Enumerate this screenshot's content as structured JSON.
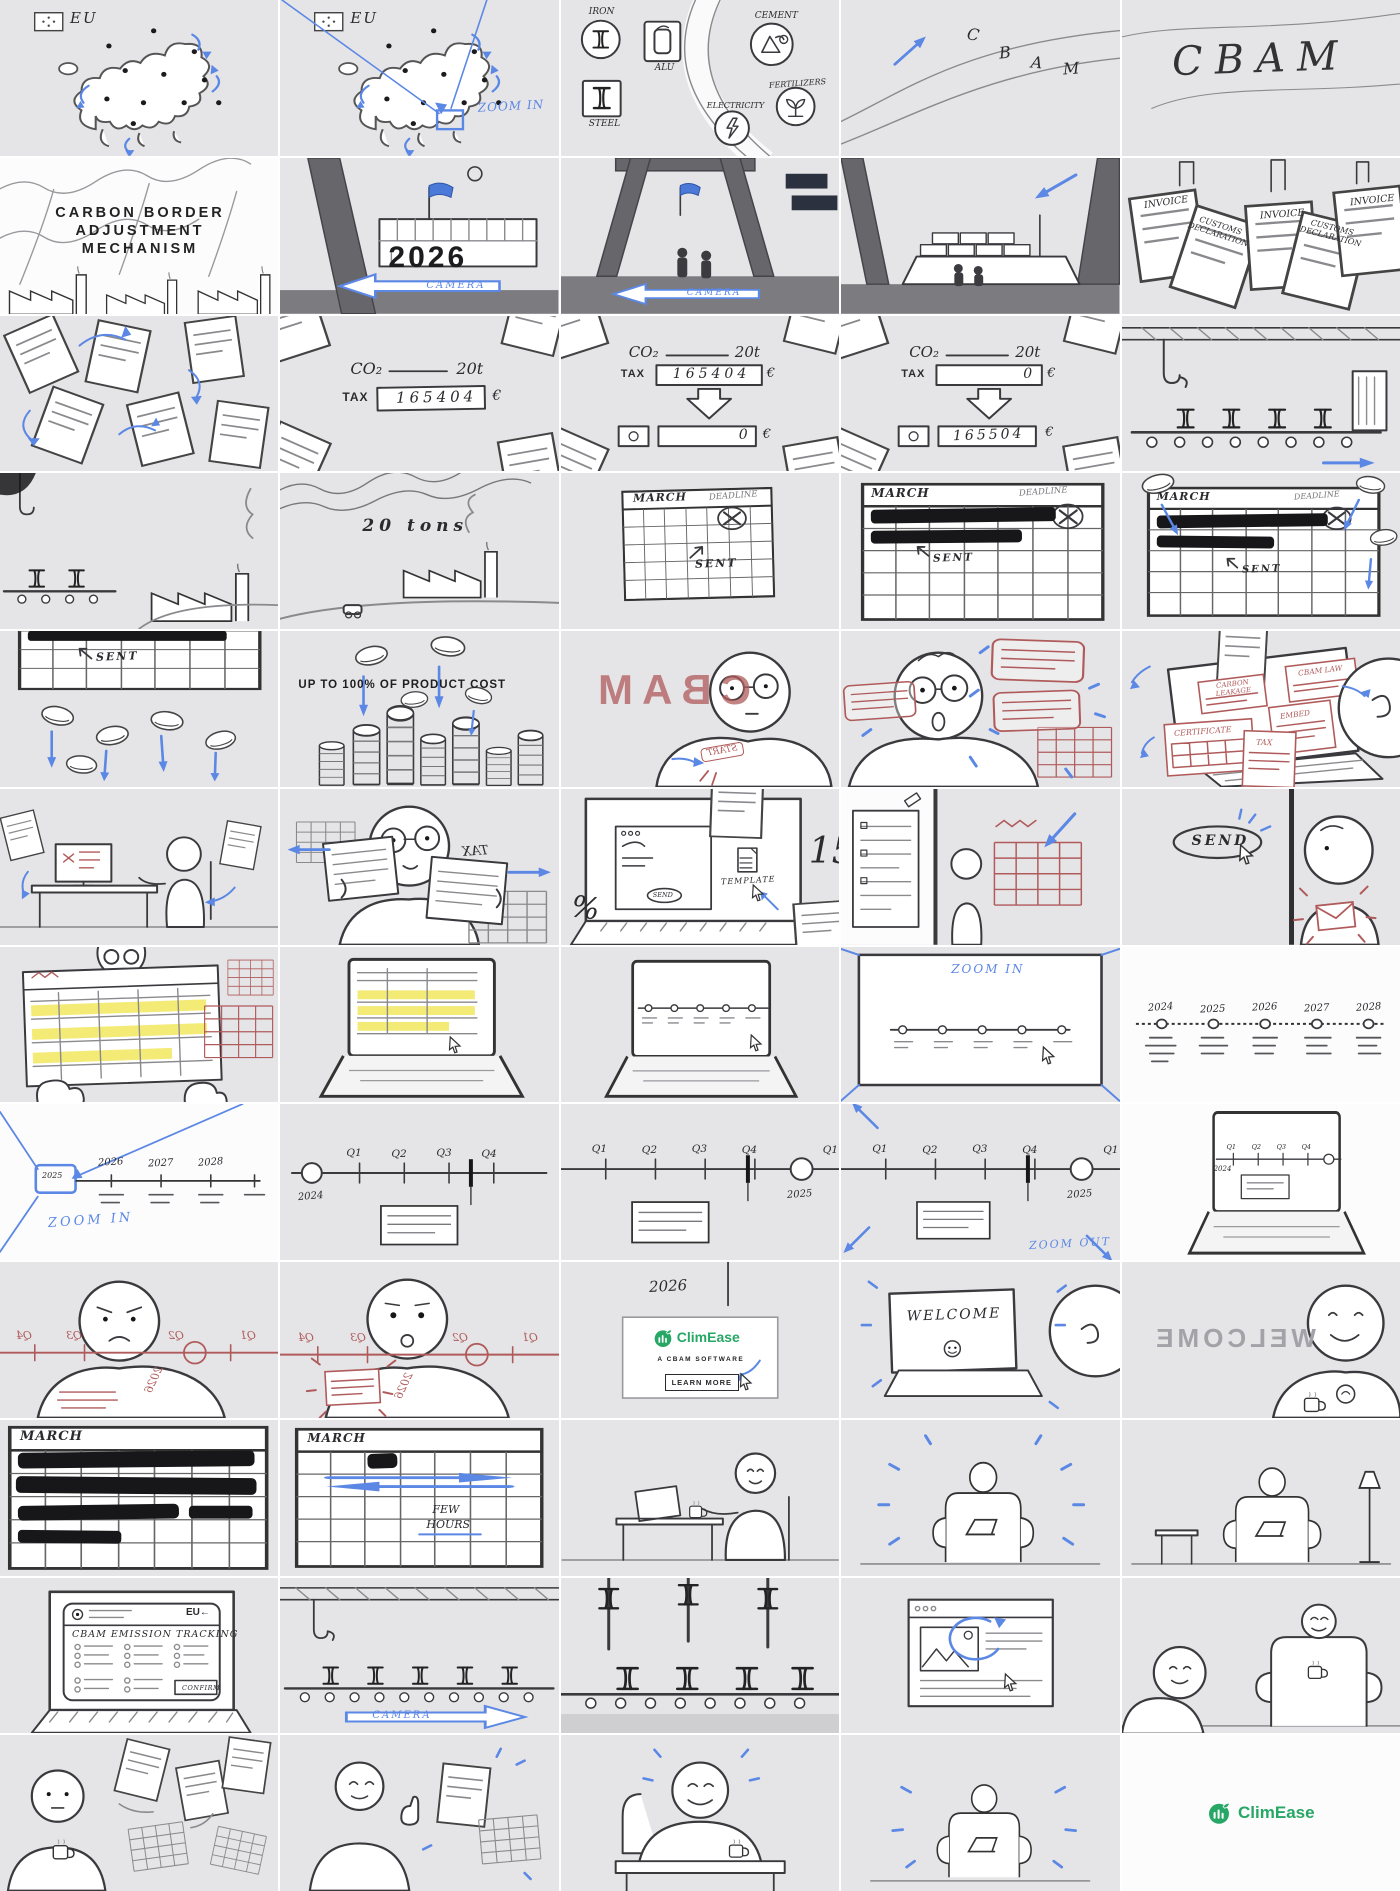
{
  "colors": {
    "panel_bg": "#e5e5e7",
    "blue": "#5b87e5",
    "red": "#b05b5b",
    "green": "#27a765",
    "yellow": "#f1e75e",
    "ink": "#2b2b2f"
  },
  "panels": {
    "r1c1": {
      "eu": "EU"
    },
    "r1c2": {
      "eu": "EU",
      "zoom": "ZOOM IN"
    },
    "r1c3": {
      "iron": "IRON",
      "alu": "ALU",
      "steel": "STEEL",
      "cement": "CEMENT",
      "electricity": "ELECTRICITY",
      "fertilizers": "FERTILIZERS"
    },
    "r1c4": {
      "l1": "C",
      "l2": "B",
      "l3": "A",
      "l4": "M"
    },
    "r1c5": {
      "title": "CBAM"
    },
    "r2c1": {
      "line1": "CARBON BORDER",
      "line2": "ADJUSTMENT",
      "line3": "MECHANISM"
    },
    "r2c2": {
      "year": "2026",
      "camera": "CAMERA"
    },
    "r2c3": {
      "camera": "CAMERA"
    },
    "r2c5": {
      "d1": "INVOICE",
      "d2": "CUSTOMS DECLARATION",
      "d3": "INVOICE",
      "d4": "CUSTOMS DECLARATION",
      "d5": "INVOICE"
    },
    "r3c2": {
      "co2": "CO₂",
      "tons": "20t",
      "tax": "TAX",
      "value": "165404",
      "eur": "€"
    },
    "r3c3": {
      "co2": "CO₂",
      "tons": "20t",
      "tax": "TAX",
      "value": "165404",
      "eur": "€",
      "result": "0",
      "eur2": "€"
    },
    "r3c4": {
      "co2": "CO₂",
      "tons": "20t",
      "tax": "TAX",
      "value": "0",
      "eur": "€",
      "result": "165504",
      "eur2": "€"
    },
    "r4c2": {
      "amount": "20 tons"
    },
    "r4c3": {
      "month": "MARCH",
      "deadline": "DEADLINE",
      "sent": "SENT"
    },
    "r4c4": {
      "month": "MARCH",
      "deadline": "DEADLINE",
      "sent": "SENT"
    },
    "r4c5": {
      "month": "MARCH",
      "deadline": "DEADLINE",
      "sent": "SENT"
    },
    "r5c1": {
      "sent": "SENT"
    },
    "r5c2": {
      "caption": "UP TO 100% OF PRODUCT COST"
    },
    "r5c3": {
      "mirrored_title": "CBAM",
      "stamp": "START"
    },
    "r5c5": {
      "doc1": "CARBON LEAKAGE",
      "doc2": "CBAM LAW",
      "doc3": "EMBED",
      "doc4": "CERTIFICATE",
      "doc5": "TAX"
    },
    "r6c2": {
      "mirrored": "TAX"
    },
    "r6c3": {
      "send": "SEND",
      "template": "TEMPLATE",
      "percent": "%",
      "number": "15"
    },
    "r6c5": {
      "send": "SEND"
    },
    "r7c4": {
      "zoom": "ZOOM IN"
    },
    "r7c5": {
      "years": [
        "2024",
        "2025",
        "2026",
        "2027",
        "2028"
      ]
    },
    "r8c1": {
      "years": [
        "2025",
        "2026",
        "2027",
        "2028"
      ],
      "zoom": "ZOOM IN"
    },
    "r8c2": {
      "quarters": [
        "Q1",
        "Q2",
        "Q3",
        "Q4"
      ],
      "year": "2024"
    },
    "r8c3": {
      "quarters": [
        "Q1",
        "Q2",
        "Q3",
        "Q4"
      ],
      "year": "2025",
      "next": "Q1"
    },
    "r8c4": {
      "quarters": [
        "Q1",
        "Q2",
        "Q3",
        "Q4"
      ],
      "year": "2025",
      "next": "Q1",
      "zoom_out": "ZOOM OUT"
    },
    "r8c5": {
      "quarters": [
        "Q1",
        "Q2",
        "Q3",
        "Q4"
      ],
      "year": "2024"
    },
    "r9c1": {
      "quarters": [
        "Q4",
        "Q3",
        "Q2",
        "Q1"
      ],
      "year": "2026"
    },
    "r9c2": {
      "quarters": [
        "Q4",
        "Q3",
        "Q2",
        "Q1"
      ],
      "year": "2026"
    },
    "r9c3": {
      "year": "2026",
      "brand": "ClimEase",
      "tagline": "A CBAM SOFTWARE",
      "cta": "LEARN MORE"
    },
    "r9c4": {
      "welcome": "WELCOME"
    },
    "r9c5": {
      "welcome": "WELCOME"
    },
    "r10c1": {
      "month": "MARCH"
    },
    "r10c2": {
      "month": "MARCH",
      "note1": "FEW",
      "note2": "HOURS"
    },
    "r11c1": {
      "app": "CBAM EMISSION TRACKING",
      "eu": "EU←",
      "confirm": "CONFIRM"
    },
    "r11c2": {
      "camera": "CAMERA"
    },
    "r12c5": {
      "brand": "ClimEase"
    }
  }
}
